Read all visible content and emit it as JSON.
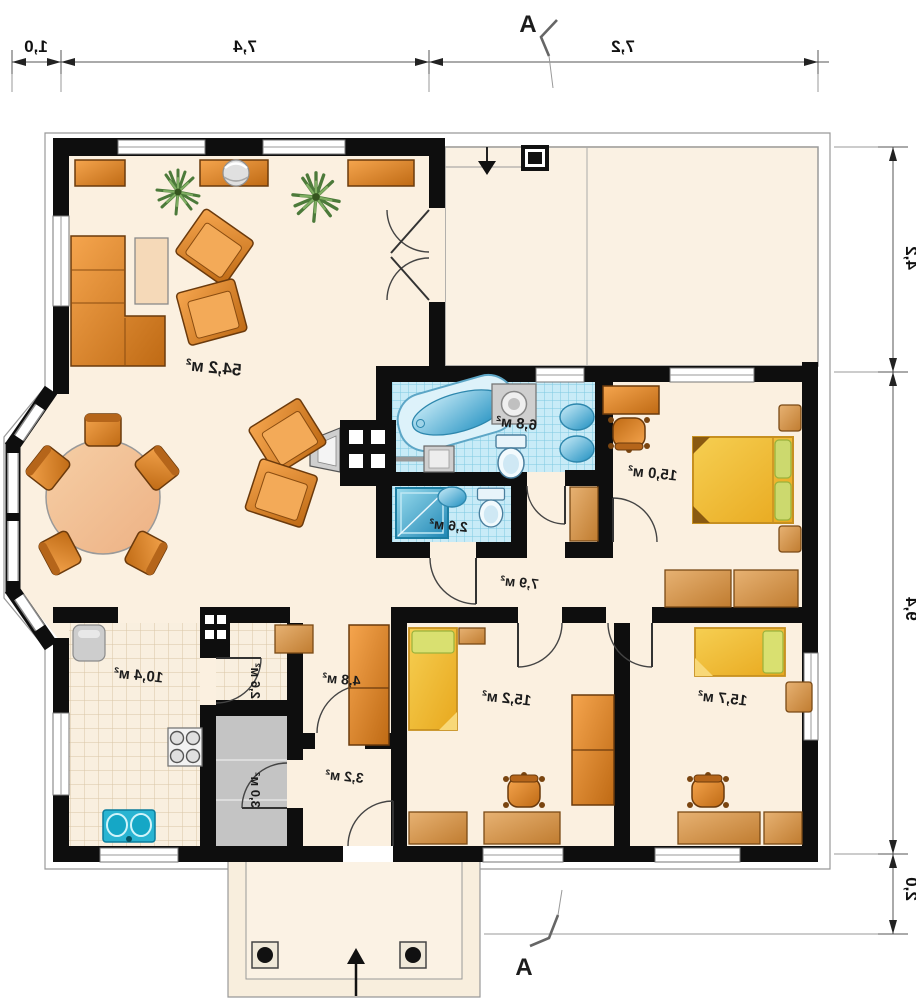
{
  "plan": {
    "section_marker": "A",
    "dimensions": {
      "top": [
        "1,0",
        "7,4",
        "7,2"
      ],
      "right": [
        "4,2",
        "9,4",
        "2,0"
      ]
    },
    "rooms": {
      "living_room": {
        "area": "54,2 м²"
      },
      "bathroom": {
        "area": "6,8 м²"
      },
      "wc": {
        "area": "2,6 м²"
      },
      "bedroom_right": {
        "area": "15,0 м²"
      },
      "hall": {
        "area": "7,9 м²"
      },
      "kitchen": {
        "area": "10,4 м²"
      },
      "pantry": {
        "area": "2,6 м²"
      },
      "boiler_room": {
        "area": "3,0 м²"
      },
      "hallway": {
        "area": "3,2 м²"
      },
      "corridor": {
        "area": "4,8 м²"
      },
      "bedroom_bottom_left": {
        "area": "15,2 м²"
      },
      "bedroom_bottom_right": {
        "area": "15,7 м²"
      }
    },
    "colors": {
      "wall": "#0e0e0e",
      "floor": "#fbf0e0",
      "tile_blue": "#c8ebf7",
      "tile_grid": "#7ec9e2",
      "furniture_orange": "#e08a30",
      "wood_tan": "#d49a58",
      "bed_yellow": "#f3c33c",
      "pillow_green": "#ccd96e",
      "water_teal": "#2ab6d4",
      "utility_gray": "#c4c4c4",
      "plant_green": "#5d8c49"
    }
  }
}
